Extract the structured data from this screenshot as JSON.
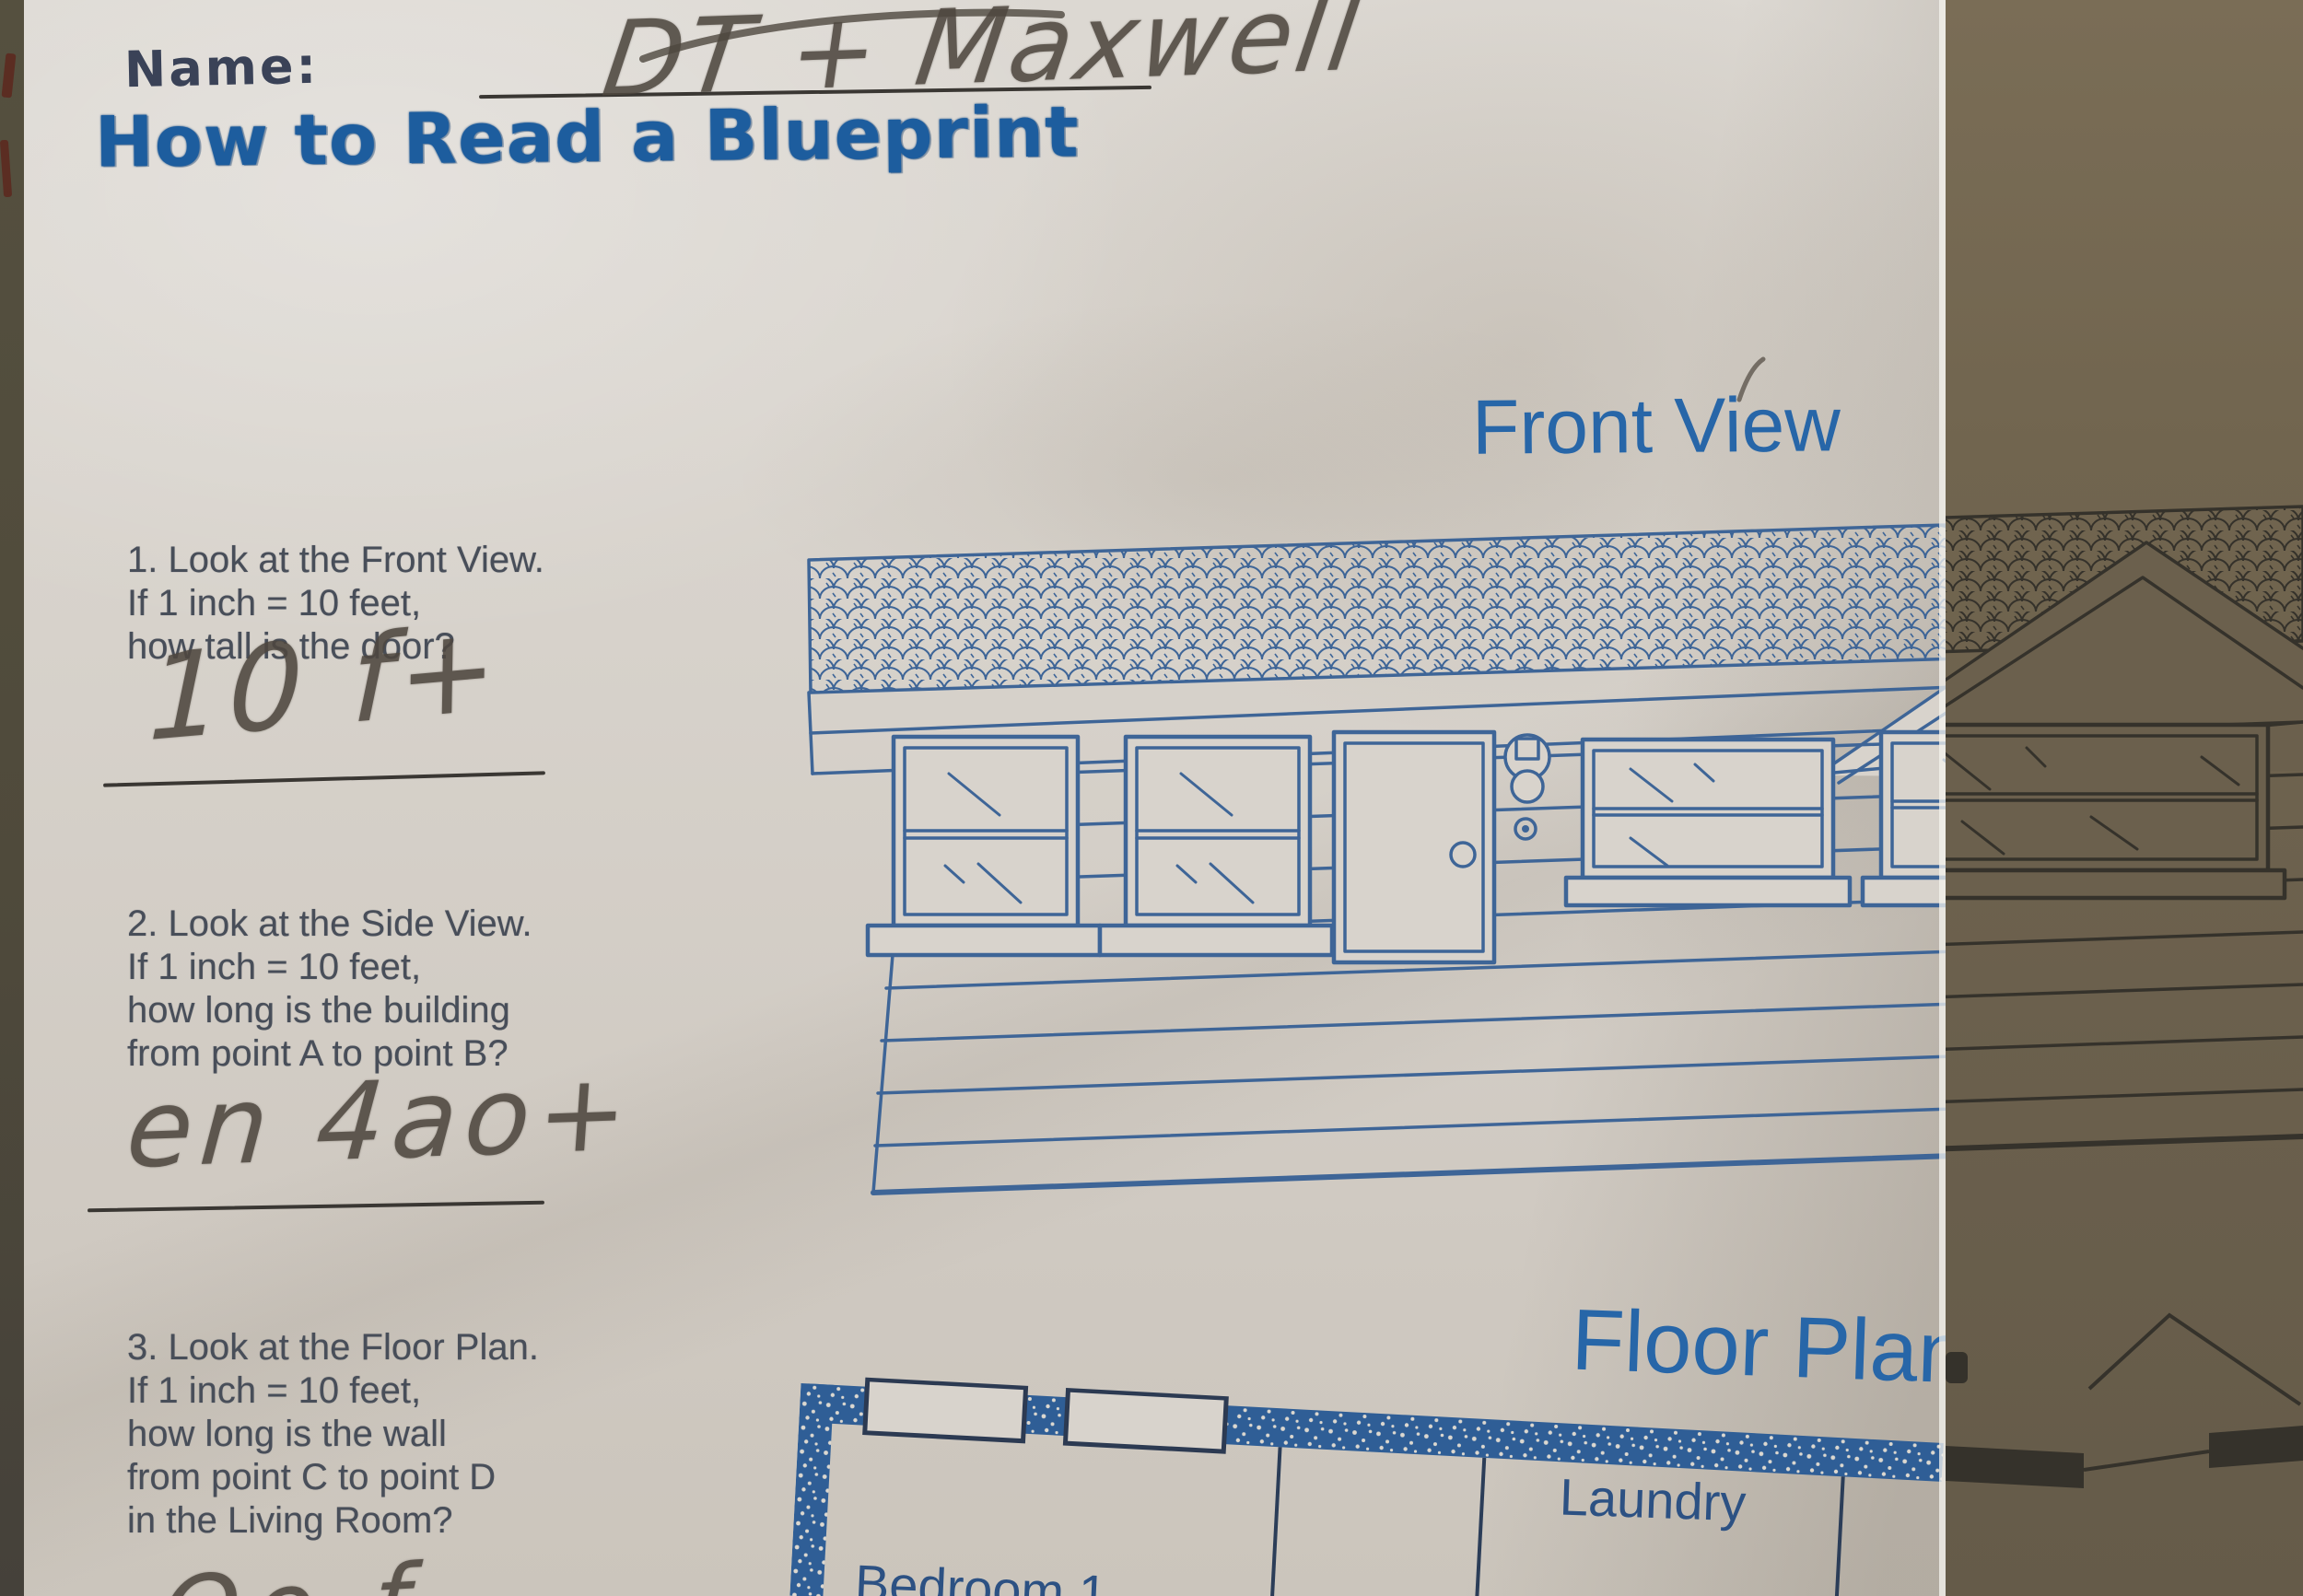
{
  "header": {
    "name_label": "Name:",
    "title": "How to Read a Blueprint"
  },
  "handwriting": {
    "name": "DT + Maxwell",
    "answer1": "10 f+",
    "answer2": "en 4ao+",
    "answer3_partial": "Oo f"
  },
  "labels": {
    "front_view": "Front View",
    "floor_plan": "Floor Plan"
  },
  "questions": [
    {
      "lines": [
        "1. Look at the Front View.",
        "If 1 inch = 10 feet,",
        "how tall is the door?"
      ]
    },
    {
      "lines": [
        "2. Look at the Side View.",
        "If 1 inch = 10 feet,",
        "how long is the building",
        "from point A to point B?"
      ]
    },
    {
      "lines": [
        "3. Look at the Floor Plan.",
        "If 1 inch = 10 feet,",
        "how long is the wall",
        "from point C to point D",
        "in the Living Room?"
      ]
    }
  ],
  "floor_plan": {
    "rooms": [
      {
        "label": "Laundry"
      },
      {
        "label": "Bedroom 1"
      }
    ]
  },
  "colors": {
    "print_blue": "#3e6597",
    "label_blue": "#2766a8",
    "title_blue": "#1d5d9e",
    "pencil_gray": "#4e473f",
    "question_text": "#484e59",
    "paper": "#d7d2cb",
    "desk_brown": "#6e6250",
    "shadow_print": "#35322b"
  }
}
